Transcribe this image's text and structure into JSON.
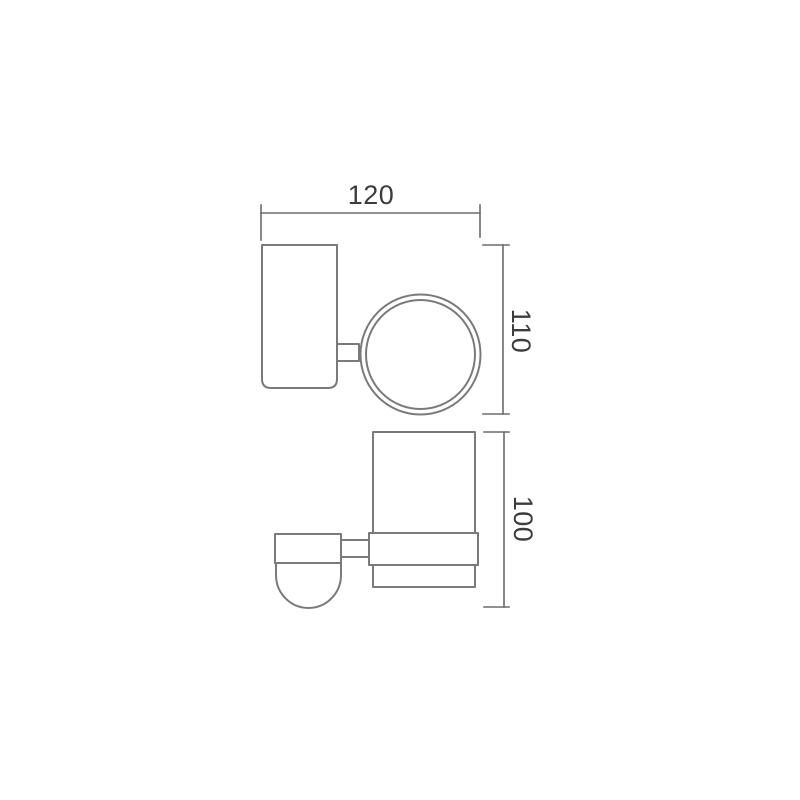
{
  "dimensions": {
    "overall_width": "120",
    "upper_view_height": "110",
    "lower_view_height": "100"
  },
  "colors": {
    "background": "#ffffff",
    "outline": "#7a7a7a",
    "dimension": "#6b6b6b",
    "text": "#3c3c3c"
  }
}
